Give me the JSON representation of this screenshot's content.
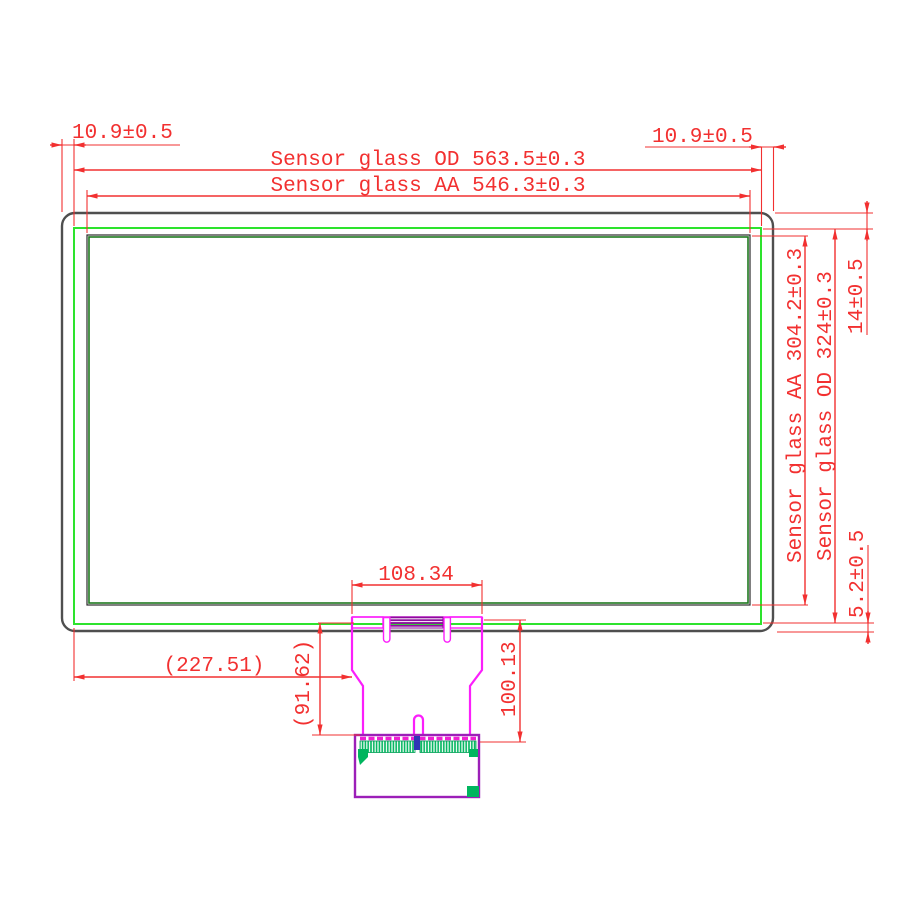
{
  "dimensions": {
    "left_margin": "10.9±0.5",
    "right_margin": "10.9±0.5",
    "sensor_od_width": "Sensor glass OD 563.5±0.3",
    "sensor_aa_width": "Sensor glass AA 546.3±0.3",
    "top_margin": "14±0.5",
    "sensor_aa_height": "Sensor glass AA 304.2±0.3",
    "sensor_od_height": "Sensor glass OD 324±0.3",
    "bottom_margin": "5.2±0.5",
    "tail_width": "108.34",
    "tail_offset_left": "(227.51)",
    "tail_drop": "(91.62)",
    "tail_length": "100.13"
  },
  "colors": {
    "dimension_red": "#f23030",
    "cover_gray": "#4f4f4f",
    "sensor_od_green": "#2de32d",
    "sensor_aa_dark_green": "#1f7a1f",
    "fpc_magenta": "#fb1ffb",
    "bonding_purple": "#8b0a9b",
    "pcb_purple": "#9c1fb8",
    "component_green": "#00b55e"
  }
}
